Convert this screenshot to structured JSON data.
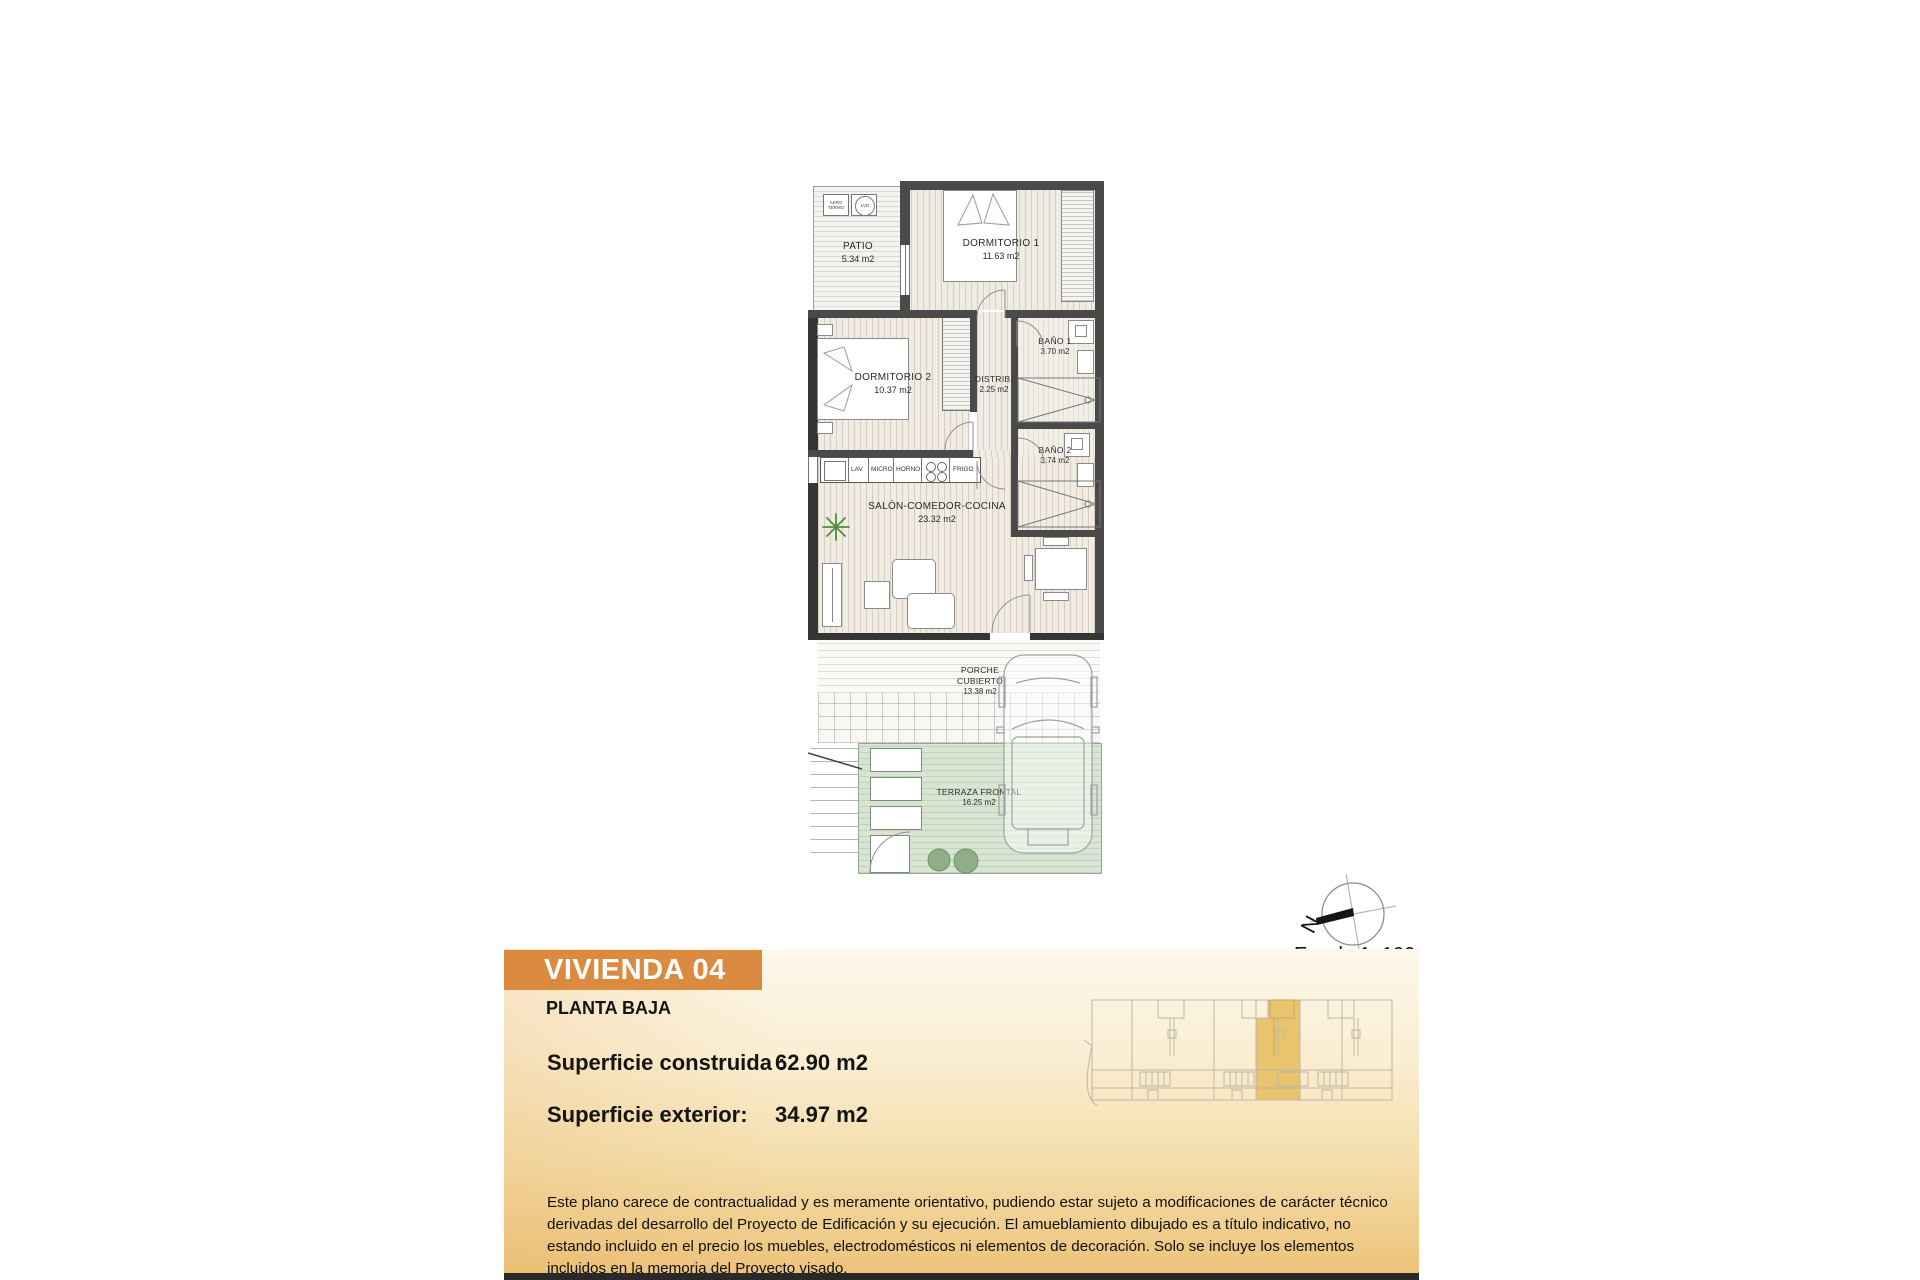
{
  "plan": {
    "rooms": [
      {
        "name": "PATIO",
        "area": "5.34 m2"
      },
      {
        "name": "DORMITORIO 1",
        "area": "11.63 m2"
      },
      {
        "name": "DORMITORIO 2",
        "area": "10.37 m2"
      },
      {
        "name": "BAÑO 1",
        "area": "3.70 m2"
      },
      {
        "name": "DISTRIB.",
        "area": "2.25 m2"
      },
      {
        "name": "BAÑO 2",
        "area": "3.74 m2"
      },
      {
        "name": "SALÓN-COMEDOR-COCINA",
        "area": "23.32 m2"
      },
      {
        "name": "PORCHE CUBIERTO",
        "area": "13.38 m2"
      },
      {
        "name": "TERRAZA FRONTAL",
        "area": "16.25 m2"
      }
    ],
    "kitchen_labels": [
      "LAV",
      "MICRO",
      "HORNO",
      "FRIGO"
    ],
    "appliances": {
      "aerotermo": "AERO TERMO",
      "washer": "LVD"
    }
  },
  "compass": {
    "north_label": "N"
  },
  "scale_label": "Escala 1: 100",
  "info": {
    "unit_title": "VIVIENDA 04",
    "floor_label": "PLANTA BAJA",
    "built_label": "Superficie construida :",
    "built_value": "62.90 m2",
    "exterior_label": "Superficie exterior:",
    "exterior_value": "34.97 m2"
  },
  "disclaimer": "Este plano carece de contractualidad y es meramente orientativo, pudiendo estar sujeto a modificaciones de carácter técnico derivadas del desarrollo del Proyecto de Edificación y su ejecución. El amueblamiento dibujado es a título indicativo, no estando incluido en el precio los muebles, electrodomésticos ni elementos de decoración. Solo se incluye los elementos incluidos en la memoria del Proyecto visado.",
  "colors": {
    "accent_orange": "#db8b3f",
    "highlight_gold": "#e9c46f",
    "terrace_green": "#d8e5d3",
    "wall_gray": "#4a4a4a"
  }
}
